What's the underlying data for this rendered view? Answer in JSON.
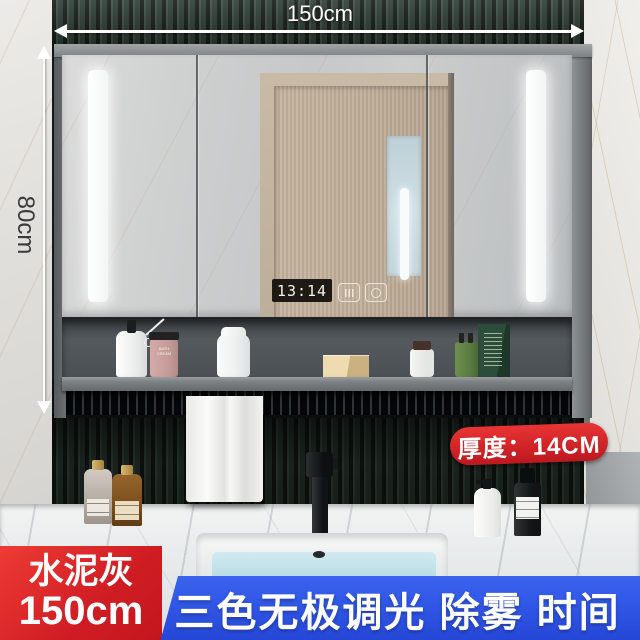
{
  "dimensions": {
    "width_label": "150cm",
    "height_label": "80cm",
    "thickness_badge": "厚度：14CM"
  },
  "mirror": {
    "clock_time": "13:14",
    "touch_icons": [
      "defog-icon",
      "power-icon"
    ]
  },
  "shelf": {
    "jar_label": "BATH CREAM"
  },
  "footer": {
    "color_name": "水泥灰",
    "size_label": "150cm",
    "features_banner": "三色无极调光 除雾 时间"
  },
  "colors": {
    "accent_red": "#d6222a",
    "accent_blue": "#2b52e0",
    "wall_green": "#2e3d35",
    "led_white": "#ffffff",
    "water_blue": "#b9dde8"
  }
}
